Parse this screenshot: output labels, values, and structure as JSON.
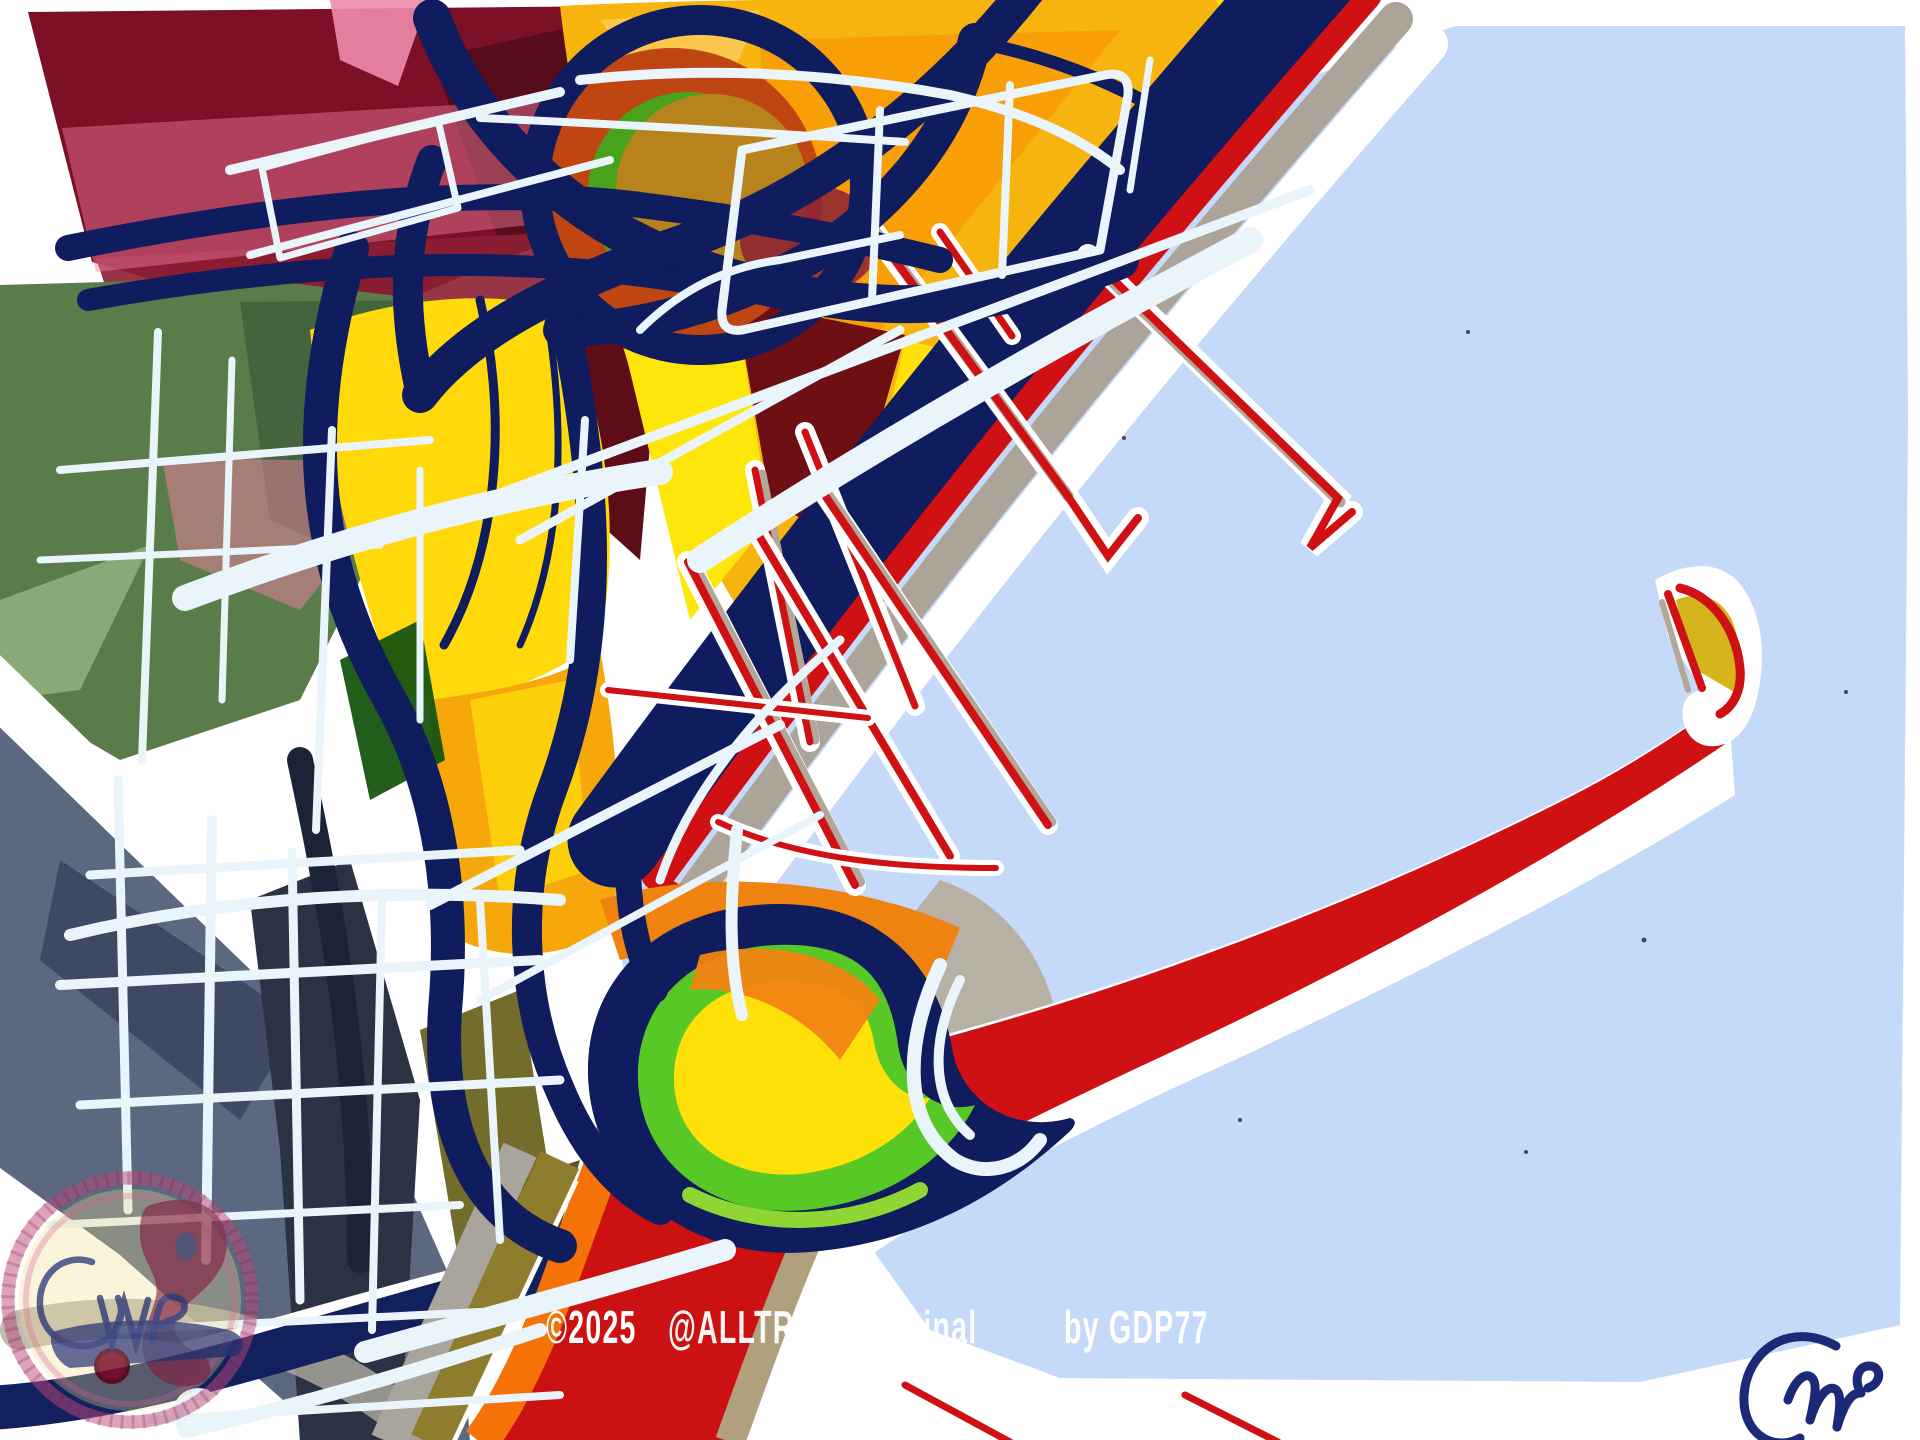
{
  "caption": {
    "copyright": "©2025",
    "handle": "@ALLTRAITSoriginal",
    "byline": "by GDP77"
  },
  "palette": {
    "canvas_white": "#ffffff",
    "sky_blue": "#c5d9f8",
    "navy": "#0f1c5e",
    "red": "#cf1113",
    "maroon": "#7c1026",
    "pink": "#ef7fa2",
    "orange_sail": "#f7b30e",
    "deep_orange": "#ef8111",
    "bright_yellow": "#ffe10a",
    "amber": "#f6a70b",
    "rust": "#bf4512",
    "lime_green": "#57c826",
    "field_green": "#5a7c4a",
    "slate_blue_gray": "#5b6880",
    "beige": "#ded7c9",
    "tan_shadow": "#b3a79a",
    "ice_white": "#e9f4fb",
    "watermark_ring_pink": "#bd4a7b",
    "signature_navy": "#1b2a78"
  }
}
